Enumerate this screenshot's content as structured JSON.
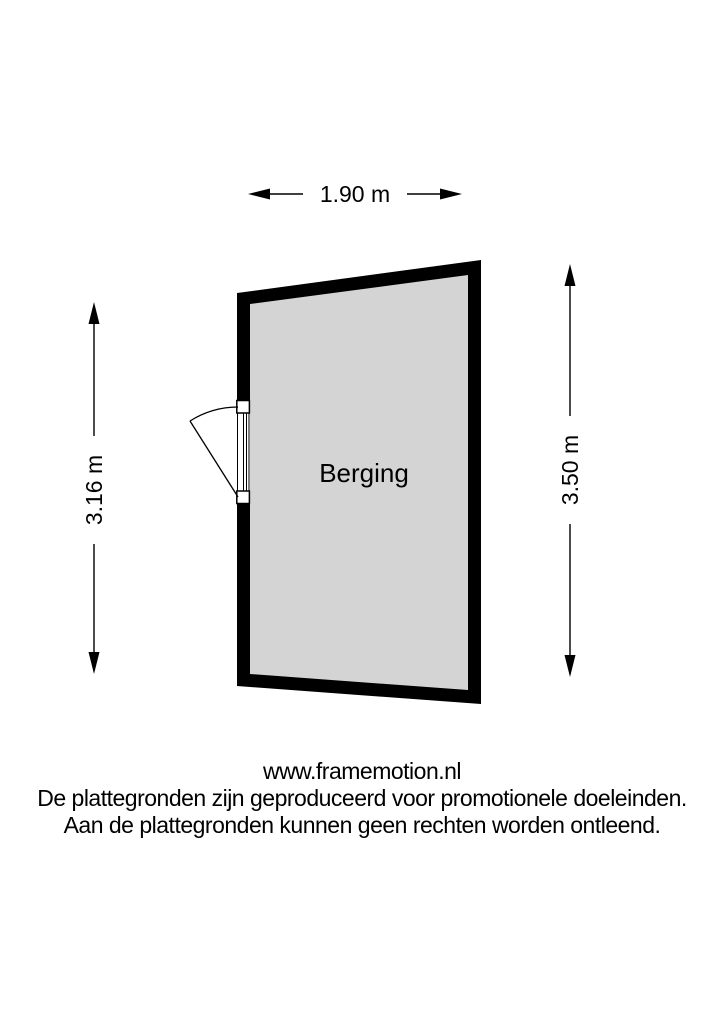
{
  "floorplan": {
    "room": {
      "label": "Berging",
      "fill": "#d4d4d4",
      "wall_color": "#000000"
    },
    "dimensions": {
      "top": "1.90 m",
      "left": "3.16 m",
      "right": "3.50 m"
    }
  },
  "footer": {
    "website": "www.framemotion.nl",
    "disclaimer_line1": "De plattegronden zijn geproduceerd voor promotionele doeleinden.",
    "disclaimer_line2": "Aan de plattegronden kunnen geen rechten worden ontleend."
  }
}
